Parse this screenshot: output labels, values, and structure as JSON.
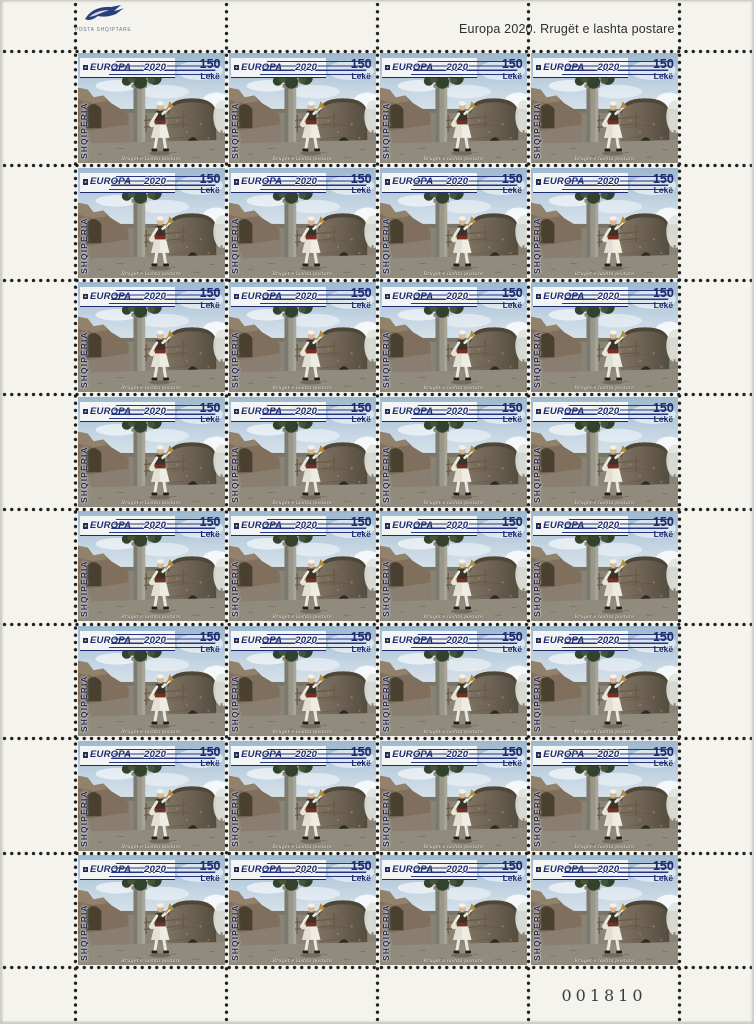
{
  "sheet": {
    "format": {
      "rows": 8,
      "cols": 4,
      "stamp_count": 32
    },
    "header": {
      "issuer_name": "POSTA SHQIPTARE",
      "title": "Europa 2020. Rrugët e lashta postare"
    },
    "footer": {
      "serial_number": "001810"
    }
  },
  "stamp": {
    "program": "EUROPA",
    "year": "2020",
    "denomination": "150",
    "currency": "Lekë",
    "country": "SHQIPËRIA",
    "caption": "Rrugët e lashta postare",
    "colors": {
      "navy": "#1d2b6e",
      "sky": "#b6c9da",
      "tower_stone": "#6b6052",
      "ground": "#8f897b"
    }
  }
}
